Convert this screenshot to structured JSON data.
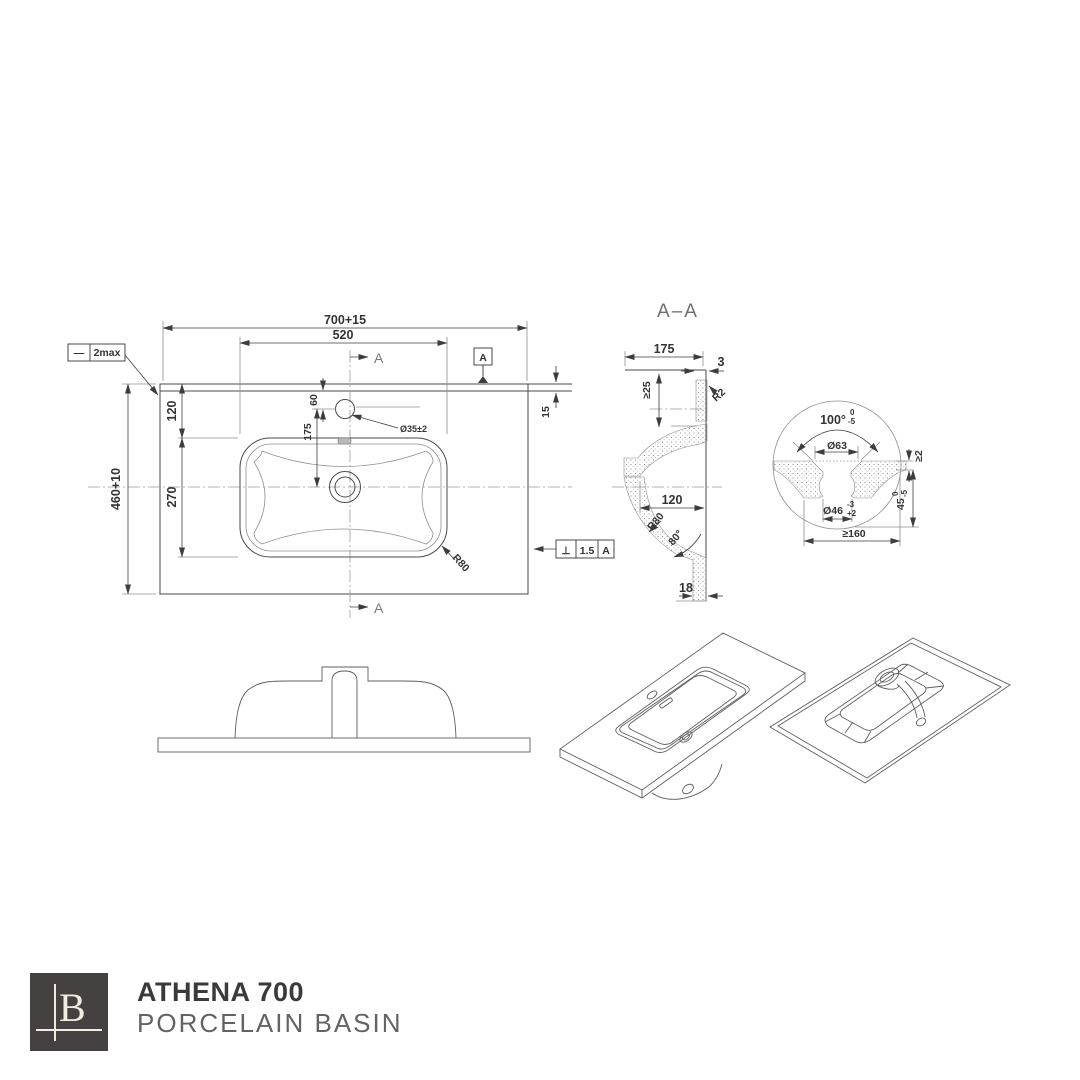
{
  "brand": {
    "logo_letter": "B",
    "title": "ATHENA 700",
    "subtitle": "PORCELAIN BASIN"
  },
  "colors": {
    "line": "#4a4a4a",
    "light_line": "#8f8f8f",
    "logo_bg": "#454140",
    "logo_fg": "#f2ecdf",
    "title_text": "#3a3a3a",
    "subtitle_text": "#636363"
  },
  "plan": {
    "dim_overall_width": "700+15",
    "dim_basin_width": "520",
    "dim_overall_depth": "460+10",
    "dim_edge_to_basin": "120",
    "dim_basin_depth": "270",
    "dim_tap_offset": "60",
    "dim_tap_to_center": "175",
    "dim_back_edge": "15",
    "dim_tap_hole": "Ø35±2",
    "dim_corner_radius": "R80",
    "flatness": {
      "symbol": "—",
      "value": "2max"
    },
    "datum": "A",
    "section_label": "A",
    "perpendicularity": {
      "symbol": "⊥",
      "value": "1.5",
      "datum": "A"
    }
  },
  "section": {
    "title": "A–A",
    "dim_depth": "175",
    "dim_rim": "3",
    "dim_min_depth": "≥25",
    "dim_rim_radius": "R2",
    "dim_bowl_width": "120",
    "dim_bowl_radius": "R80",
    "dim_wall_angle": "80°",
    "dim_outlet": "18"
  },
  "detail": {
    "dim_cone_angle": "100°",
    "cone_tol_upper": "0",
    "cone_tol_lower": "-5",
    "dim_top_dia": "Ø63",
    "dim_min_thickness": "≥2",
    "dim_recess_dia": "Ø46",
    "recess_tol_upper": "-3",
    "recess_tol_lower": "+2",
    "dim_depth": "45",
    "depth_tol_upper": "0",
    "depth_tol_lower": "-5",
    "dim_min_span": "≥160"
  }
}
